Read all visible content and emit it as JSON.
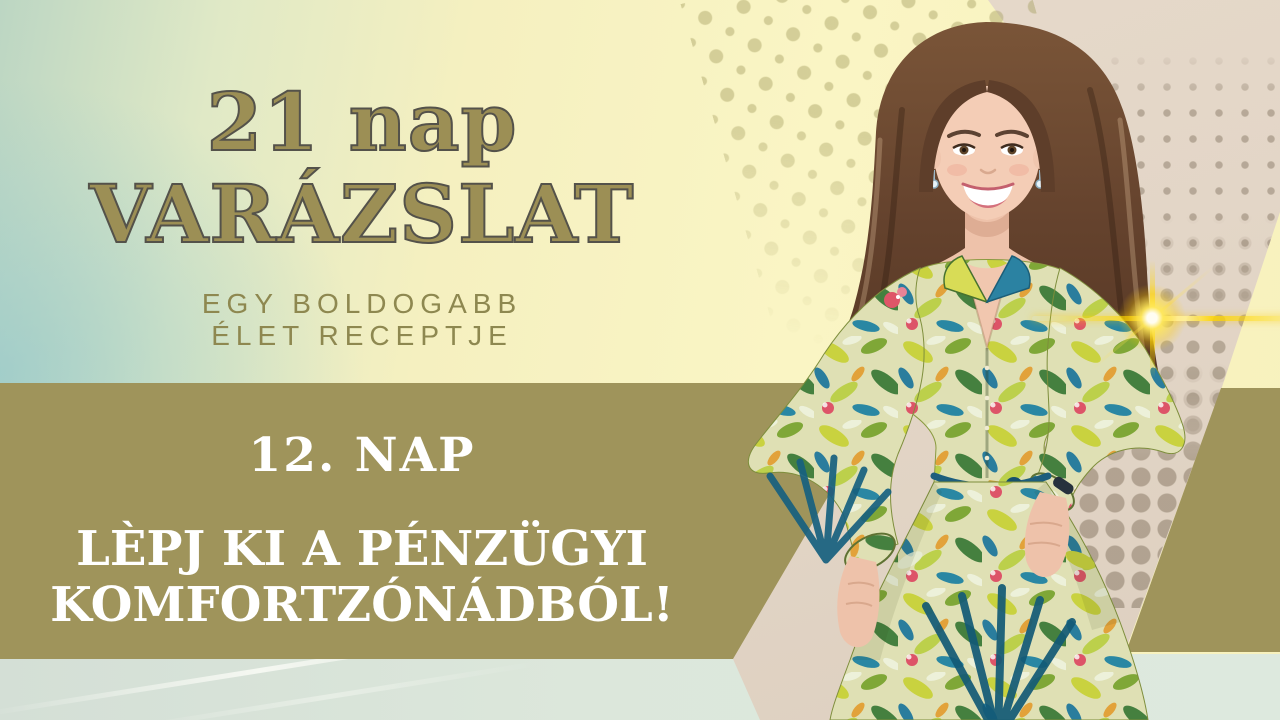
{
  "banner": {
    "title_line1": "21 nap",
    "title_line2": "VARÁZSLAT",
    "subtitle_line1": "EGY BOLDOGABB",
    "subtitle_line2": "ÉLET RECEPTJE",
    "day_label": "12. NAP",
    "headline_line1": "LÈPJ KI A PÉNZÜGYI",
    "headline_line2": "KOMFORTZÓNÁDBÓL!"
  },
  "photo": {
    "alt": "Smiling woman with shoulder-length brown hair wearing a yellow-green tropical print shirt dress with a navy cord belt, hands on hips"
  },
  "decor": {
    "sparkle_icon": "four-point-star-sparkle",
    "dots_left": "halftone-dot-grid",
    "dots_right": "halftone-dot-grid"
  },
  "colors": {
    "title_gold": "#9c8f55",
    "title_outline": "#54524a",
    "subtitle_olive": "#8e8850",
    "band_olive": "#9f945b",
    "band_text": "#ffffff",
    "bg_yellow": "#f8f3c1",
    "bg_teal": "#b7d3c6",
    "bg_beige": "#e4d7c8",
    "bottom_strip": "#d9e4da",
    "sparkle_gold": "#ffd93b"
  }
}
